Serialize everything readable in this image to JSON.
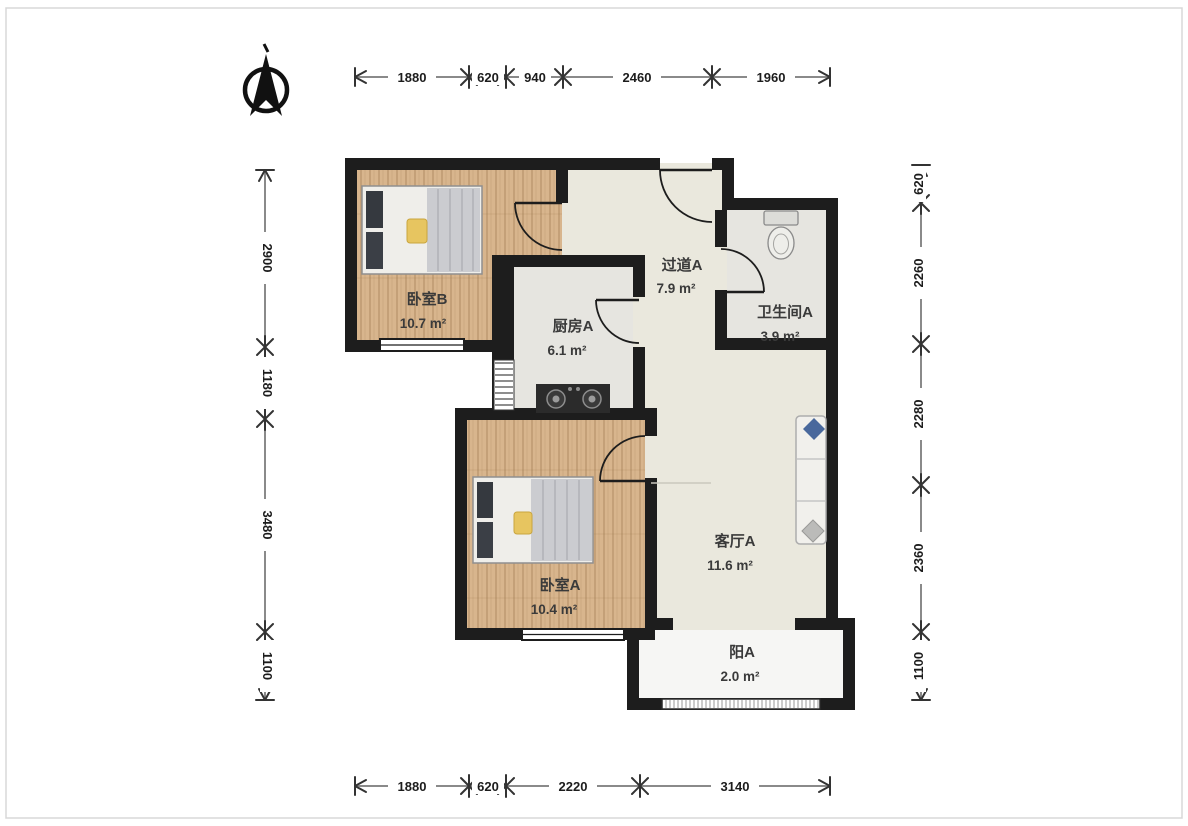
{
  "rooms": {
    "bedroom_b": {
      "name": "卧室B",
      "area": "10.7 m²"
    },
    "kitchen": {
      "name": "厨房A",
      "area": "6.1 m²"
    },
    "hallway": {
      "name": "过道A",
      "area": "7.9 m²"
    },
    "bathroom": {
      "name": "卫生间A",
      "area": "3.9 m²"
    },
    "bedroom_a": {
      "name": "卧室A",
      "area": "10.4 m²"
    },
    "living_room": {
      "name": "客厅A",
      "area": "11.6 m²"
    },
    "balcony": {
      "name": "阳A",
      "area": "2.0 m²"
    }
  },
  "dimensions_mm": {
    "top": [
      "1880",
      "620",
      "940",
      "2460",
      "1960"
    ],
    "bottom": [
      "1880",
      "620",
      "2220",
      "3140"
    ],
    "left": [
      "2900",
      "1180",
      "3480",
      "1100"
    ],
    "right": [
      "620",
      "2260",
      "2280",
      "2360",
      "1100"
    ]
  },
  "colors": {
    "wall": "#1d1d1d",
    "wood_floor": "#d8b58d",
    "tile_floor": "#e6e5e0",
    "hall_floor": "#eae8dd",
    "balcony_floor": "#f6f6f4",
    "pillow_blue": "#49689c",
    "blanket_yellow": "#e7c560",
    "dimension_line": "#8a8a8a"
  }
}
